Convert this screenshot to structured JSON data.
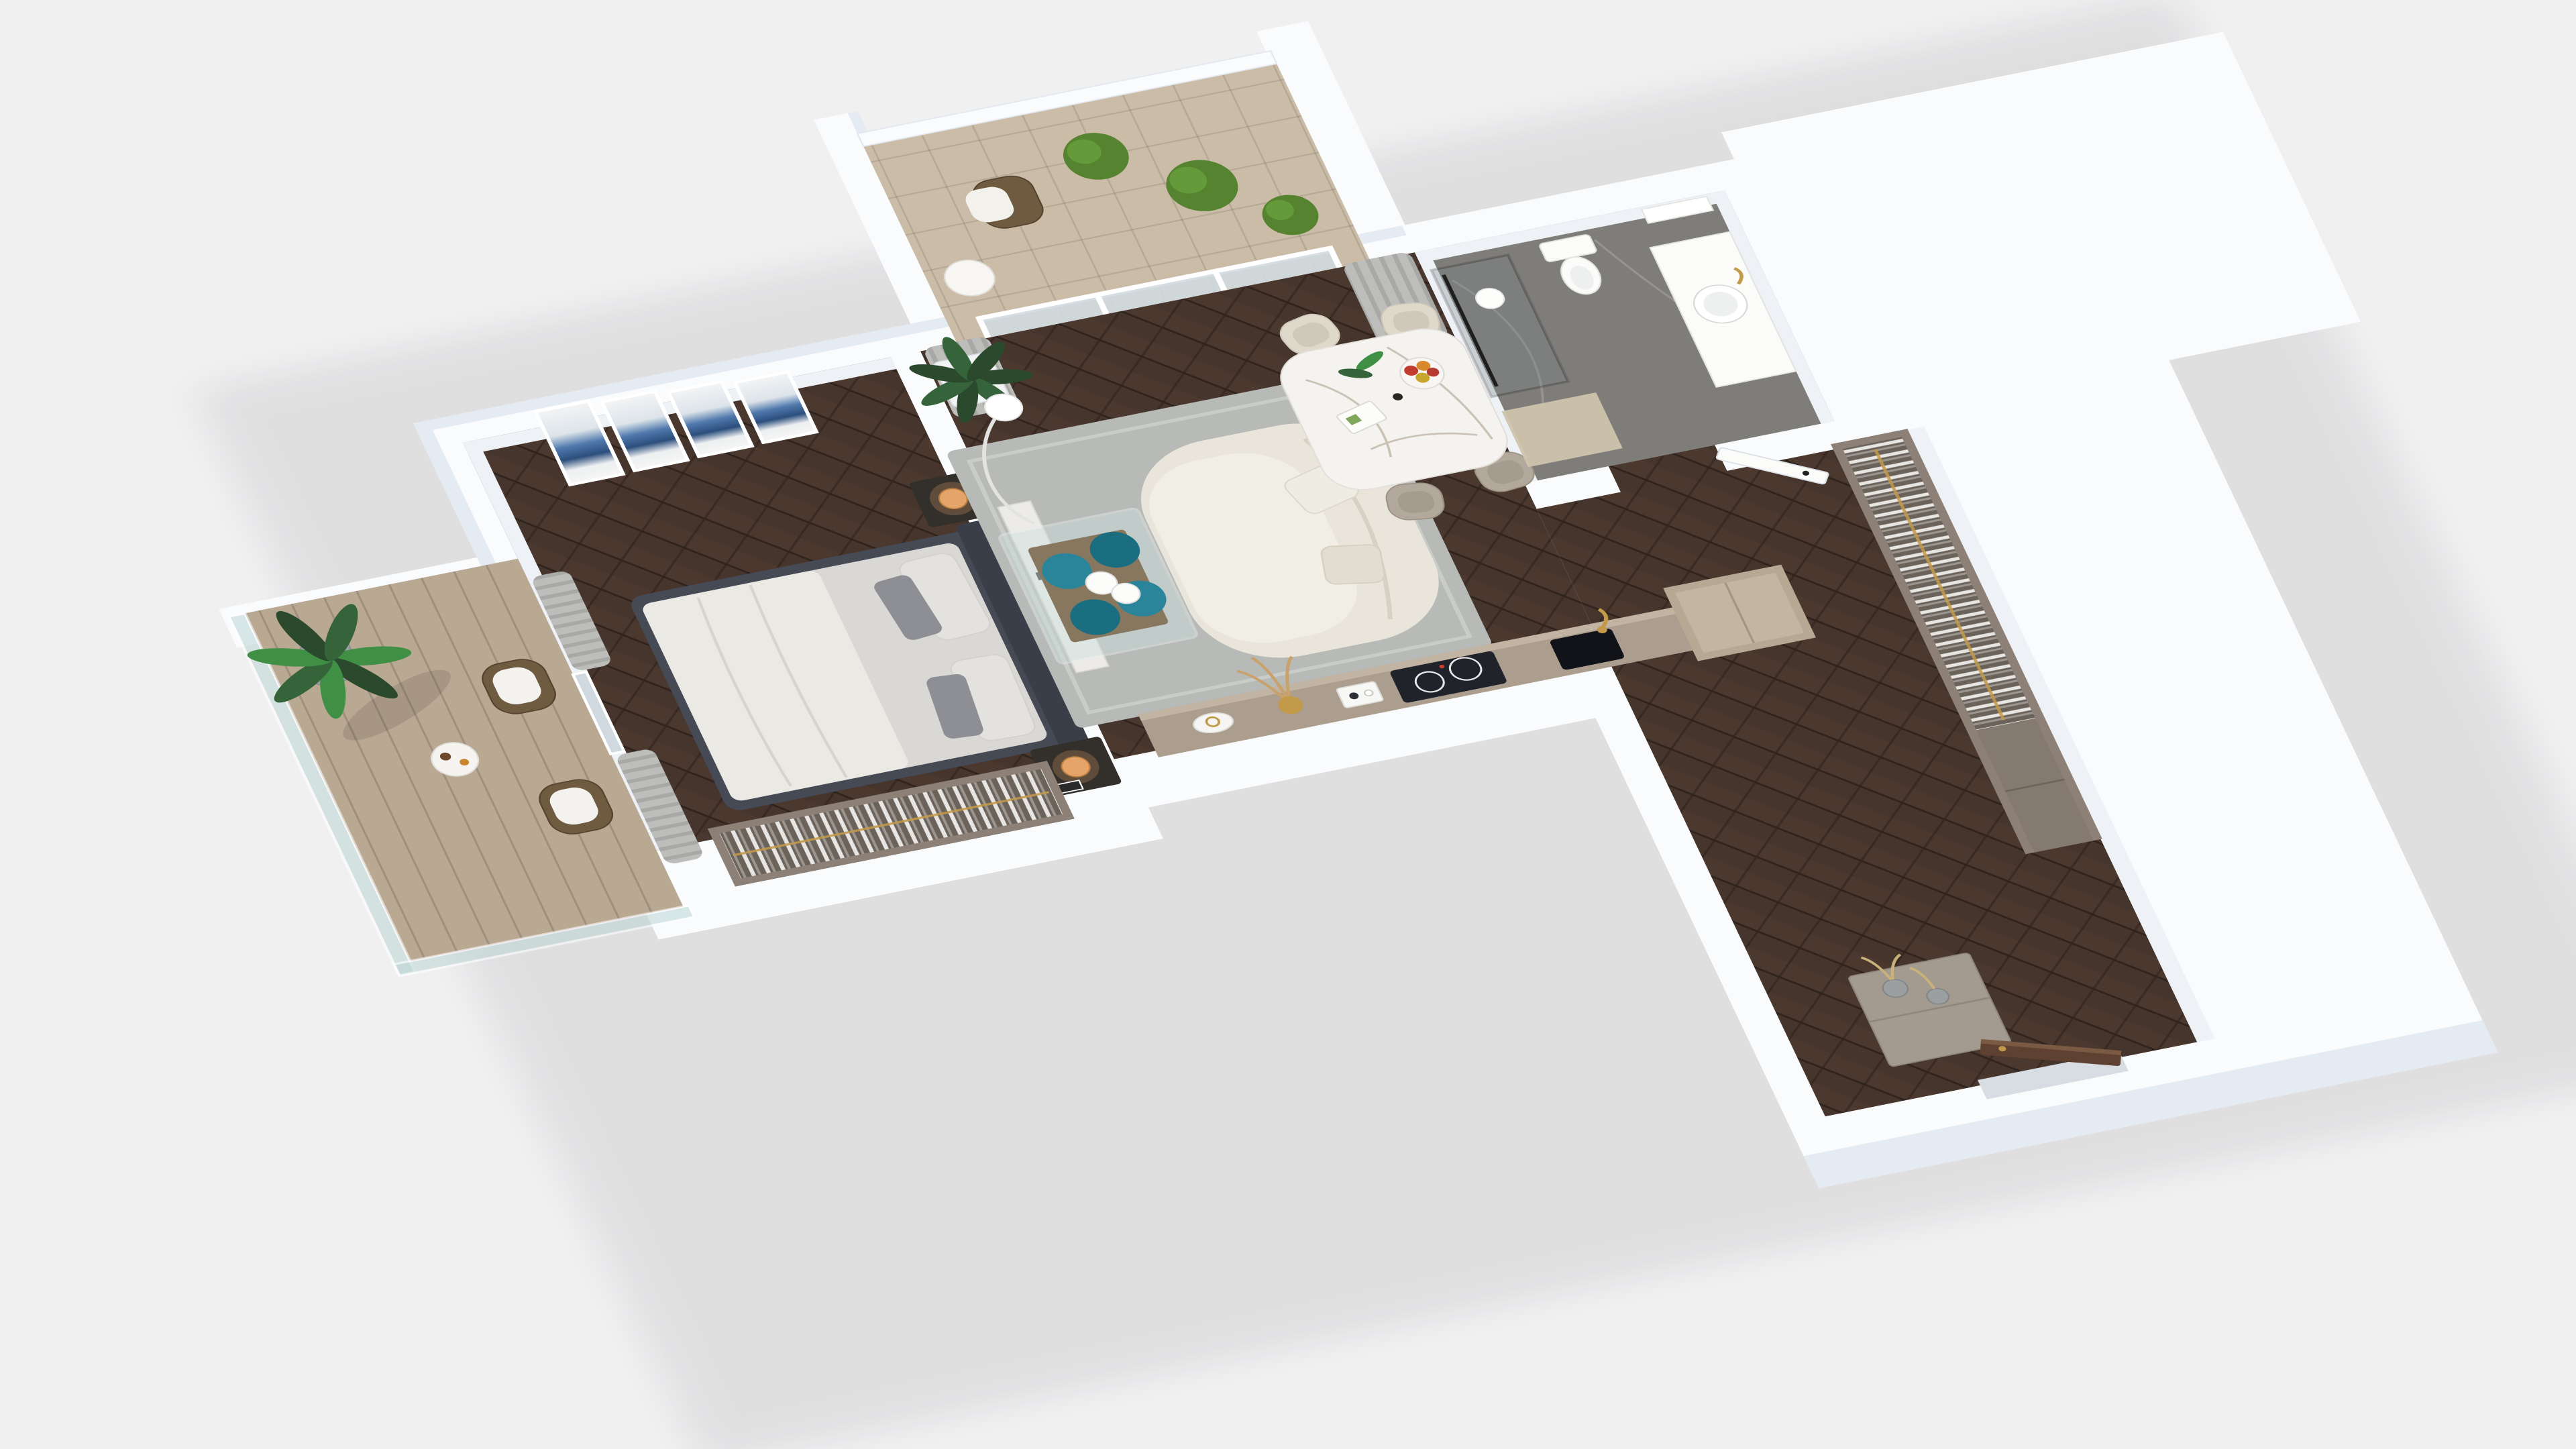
{
  "scene": {
    "type": "3d-floor-plan-render",
    "description": "Axonometric dollhouse rendering of a one-bedroom apartment with two balconies, open living-kitchen area, bathroom and wardrobe hallway",
    "projection": "top-down angled dollhouse view",
    "render_style": "photorealistic architectural visualization"
  },
  "colors": {
    "background": "#f0f0f1",
    "wall_top": "#fafbfd",
    "wall_tint": "#e4ebf3",
    "wall_side": "#d8dfe8",
    "wall_inner": "#eef1f5",
    "floor_wood": "#46352c",
    "floor_wood_light": "#5a463a",
    "floor_wood_dark": "#2f231d",
    "rug": "#b7bab7",
    "rug_border": "#c9ccc8",
    "sofa": "#e9e5da",
    "sofa_seat": "#f1eee5",
    "sofa_shadow": "#d7d1c3",
    "bed_frame": "#454a55",
    "headboard": "#3a3e49",
    "mattress": "#d9d8d4",
    "duvet": "#ebe9e4",
    "pillow_gray": "#8d8f94",
    "pillow_light": "#e3e2de",
    "nightstand": "#332f2b",
    "lamp_amber": "#e5a568",
    "curtain": "#bdbdbb",
    "curtain_shade": "#a8a8a6",
    "art_blue": "#5079ad",
    "art_blue_dark": "#2c4e7c",
    "glass": "#cfd9df",
    "glass_rail": "#bcd6d4",
    "balcony_floor": "#b9a892",
    "balcony_tile": "#cabca6",
    "bath_floor": "#7f7d7a",
    "bath_mat": "#cfc3ac",
    "white_fixture": "#fbfbfa",
    "marble_table": "#f4f3f0",
    "marble_vein": "#b9ac9d",
    "chair_cream": "#ded9cb",
    "chair_taupe": "#b2a89c",
    "teal": "#1b6e80",
    "teal_light": "#2a859a",
    "gold": "#c39a4a",
    "wardrobe_wood": "#8d8076",
    "wardrobe_inner": "#6b625a",
    "clothes_light": "#e7e6e3",
    "counter": "#ac9e8e",
    "counter_edge": "#c2b4a2",
    "cabinet_wood": "#b7a893",
    "cooktop": "#20242a",
    "walnut": "#5e4130",
    "plant_dark": "#2b4a2d",
    "plant_mid": "#35633a",
    "plant_bright": "#3f8f45",
    "shrub": "#55832f",
    "shrub_light": "#68a03c",
    "wicker": "#6f5b40",
    "planter_gray": "#9aa0a3",
    "shadow": "#0a0f14"
  },
  "rooms": [
    {
      "name": "bedroom",
      "floor": "dark herringbone parquet",
      "items": [
        "double-bed",
        "upholstered-headboard",
        "nightstand-with-amber-lamp-x2",
        "four-panel-blue-wall-art",
        "open-closet-hanging-clothes",
        "gray-curtains",
        "balcony-door"
      ]
    },
    {
      "name": "living-room",
      "floor": "dark herringbone parquet",
      "items": [
        "curved-boucle-sofa",
        "throw-pillows",
        "glass-coffee-table",
        "teal-glass-ball-stools-x4",
        "white-wire-decor-spheres",
        "gray-area-rug",
        "arc-floor-lamp",
        "potted-plant",
        "marble-media-console",
        "marble-dining-table",
        "cream-dining-chairs-x2",
        "taupe-dining-chairs-x2",
        "fruit-bowl",
        "open-magazine",
        "table-plant",
        "candle"
      ]
    },
    {
      "name": "kitchen",
      "floor": "dark herringbone parquet",
      "items": [
        "sideboard-counter",
        "induction-cooktop",
        "black-sink",
        "gold-faucet",
        "tall-cabinet",
        "decor-bowl",
        "gold-pampas-vase",
        "serving-tray"
      ]
    },
    {
      "name": "bathroom",
      "floor": "gray marble tile",
      "items": [
        "walk-in-shower-glass-screen",
        "toilet",
        "vanity-with-round-basin",
        "gold-faucet",
        "mirror-cabinet",
        "globe-pendant-light",
        "white-door-ajar",
        "wood-bath-mat"
      ]
    },
    {
      "name": "hallway",
      "floor": "dark herringbone parquet",
      "items": [
        "open-wardrobe-hanging-clothes",
        "gold-clothes-rail",
        "entry-dresser",
        "glass-vases-dried-stems",
        "walnut-entry-door"
      ]
    },
    {
      "name": "bedroom-balcony",
      "floor": "wood plank decking",
      "items": [
        "glass-railing",
        "potted-palm",
        "round-side-table",
        "coffee-cup",
        "croissant",
        "wicker-armchair-x2"
      ]
    },
    {
      "name": "living-balcony",
      "floor": "beige tile",
      "items": [
        "parapet-wall",
        "wicker-armchair",
        "round-white-table",
        "boxwood-shrub-planters-x3"
      ]
    }
  ]
}
